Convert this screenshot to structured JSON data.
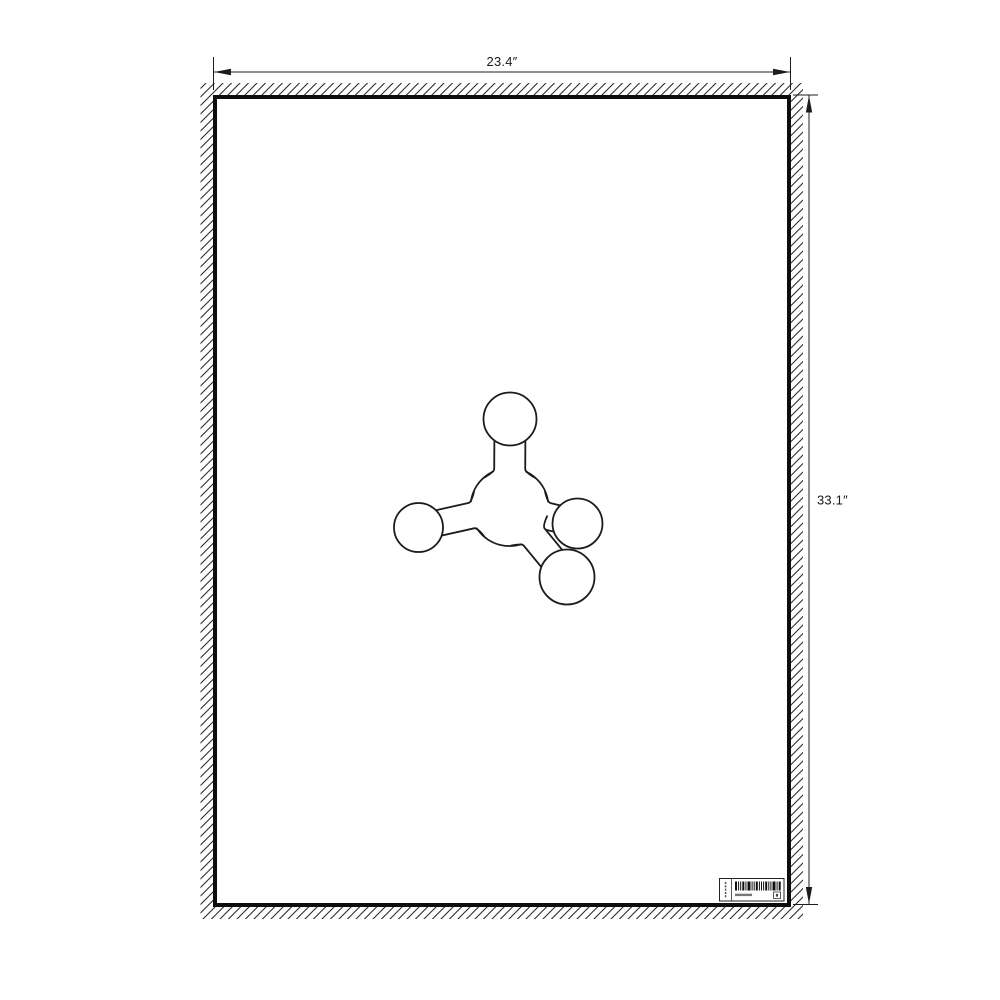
{
  "page": {
    "background": "#ffffff"
  },
  "drawing": {
    "colors": {
      "ink": "#1c1c1c",
      "poster_border": "#0d0d0d",
      "paper": "#ffffff",
      "hatch": "#2e2e2e"
    },
    "dimensions": {
      "width_label": "23.4″",
      "height_label": "33.1″"
    },
    "poster": {
      "x": 213,
      "y": 95,
      "width": 578,
      "height": 812,
      "border_px": 4,
      "hatch_band_px": 12
    },
    "dim_lines": {
      "top": {
        "y": 72,
        "x1": 213.5,
        "x2": 790.5,
        "ext_y1": 57,
        "ext_y2": 90
      },
      "right": {
        "x": 809,
        "y1": 95.5,
        "y2": 904,
        "ext_x1": 793,
        "ext_x2": 818
      }
    },
    "molecule": {
      "spheres": [
        {
          "id": "central",
          "cx": 509.5,
          "cy": 507,
          "r": 39
        },
        {
          "id": "top",
          "cx": 510,
          "cy": 419,
          "r": 26.5
        },
        {
          "id": "left",
          "cx": 418.5,
          "cy": 527.5,
          "r": 24.5
        },
        {
          "id": "right",
          "cx": 577.5,
          "cy": 523.5,
          "r": 25
        },
        {
          "id": "bottom",
          "cx": 567,
          "cy": 577,
          "r": 27.5
        }
      ],
      "bonds": [
        {
          "id": "top",
          "to": "top",
          "half_width": 15.5
        },
        {
          "id": "left",
          "to": "left",
          "half_width": 13
        },
        {
          "id": "right",
          "to": "right",
          "half_width": 13.5
        },
        {
          "id": "bottom",
          "to": "bottom",
          "half_width": 13.5
        }
      ],
      "paint_order": [
        "sphere:central",
        "bond:top",
        "bond:left",
        "bond:right",
        "sphere:top",
        "sphere:left",
        "sphere:right",
        "bond:bottom",
        "sphere:bottom"
      ]
    },
    "label": {
      "x": 719.5,
      "y": 878.5,
      "width": 64.5,
      "height": 22.5,
      "barcode_bars_pattern": "211213112111211312"
    }
  }
}
